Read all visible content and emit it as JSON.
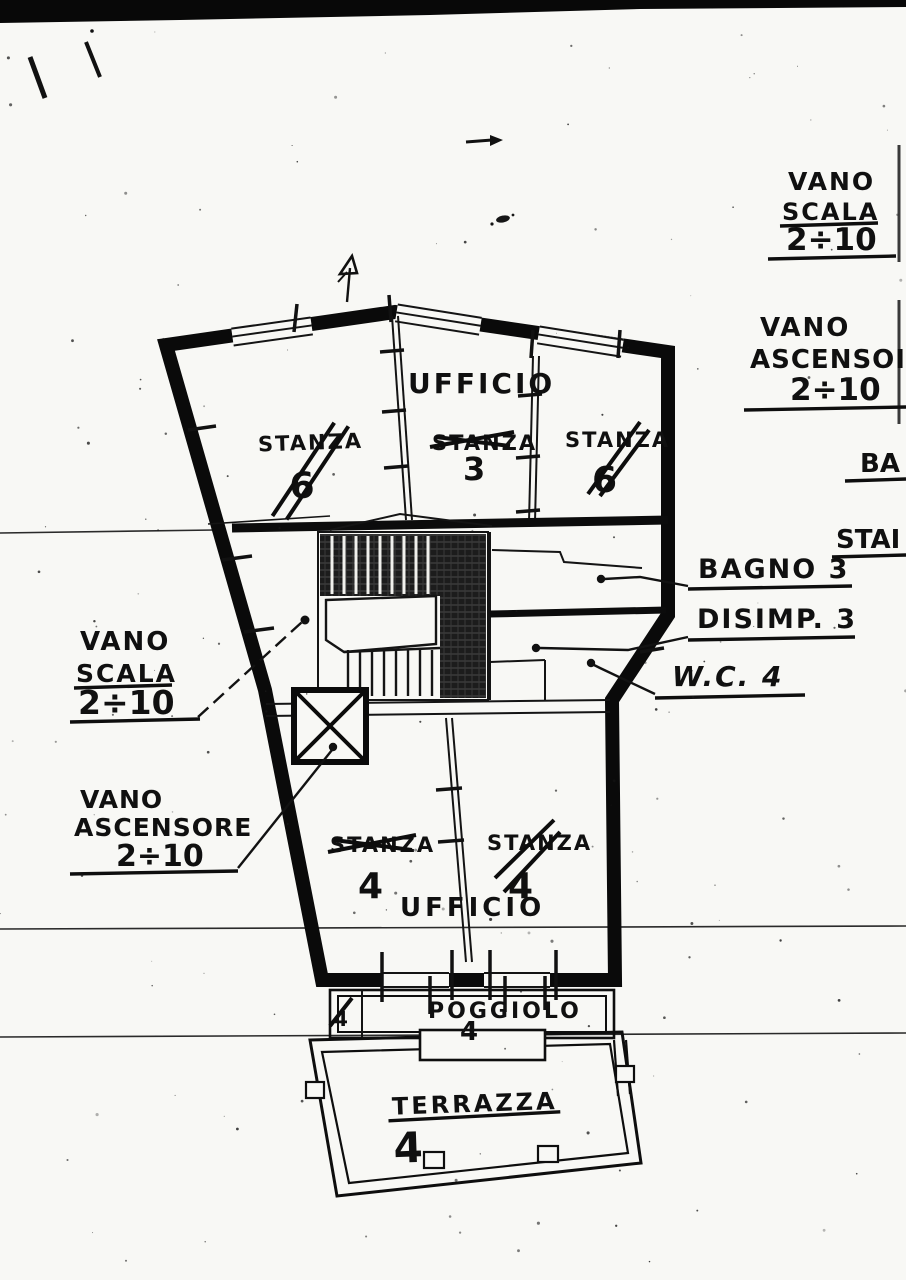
{
  "colors": {
    "paper": "#f8f8f5",
    "ink": "#0d0d0d"
  },
  "plan_labels": {
    "ufficio_top": "UFFICIO",
    "ufficio_bottom": "UFFICIO",
    "stanza_top_left": {
      "name": "STANZA",
      "number": "6"
    },
    "stanza_top_mid": {
      "name": "STANZA",
      "number": "3"
    },
    "stanza_top_right": {
      "name": "STANZA",
      "number": "6"
    },
    "stanza_bottom_left": {
      "name": "STANZA",
      "number": "4"
    },
    "stanza_bottom_right": {
      "name": "STANZA",
      "number": "4"
    },
    "poggiolo": {
      "name": "POGGIOLO",
      "number": "4",
      "side_number": "4"
    },
    "terrazza": {
      "name": "TERRAZZA",
      "number": "4"
    }
  },
  "annotations": {
    "vano_scala_top_right": {
      "line1": "VANO",
      "line2": "SCALA",
      "line3": "2÷10"
    },
    "vano_ascensore_right": {
      "line1": "VANO",
      "line2": "ASCENSOI",
      "line3": "2÷10"
    },
    "fragment_ba": "BA",
    "fragment_stai": "STAI",
    "bagno": "BAGNO 3",
    "disimp": "DISIMP. 3",
    "wc": "W.C. 4",
    "vano_scala_left": {
      "line1": "VANO",
      "line2": "SCALA",
      "line3": "2÷10"
    },
    "vano_ascensore_left": {
      "line1": "VANO",
      "line2": "ASCENSORE",
      "line3": "2÷10"
    }
  }
}
